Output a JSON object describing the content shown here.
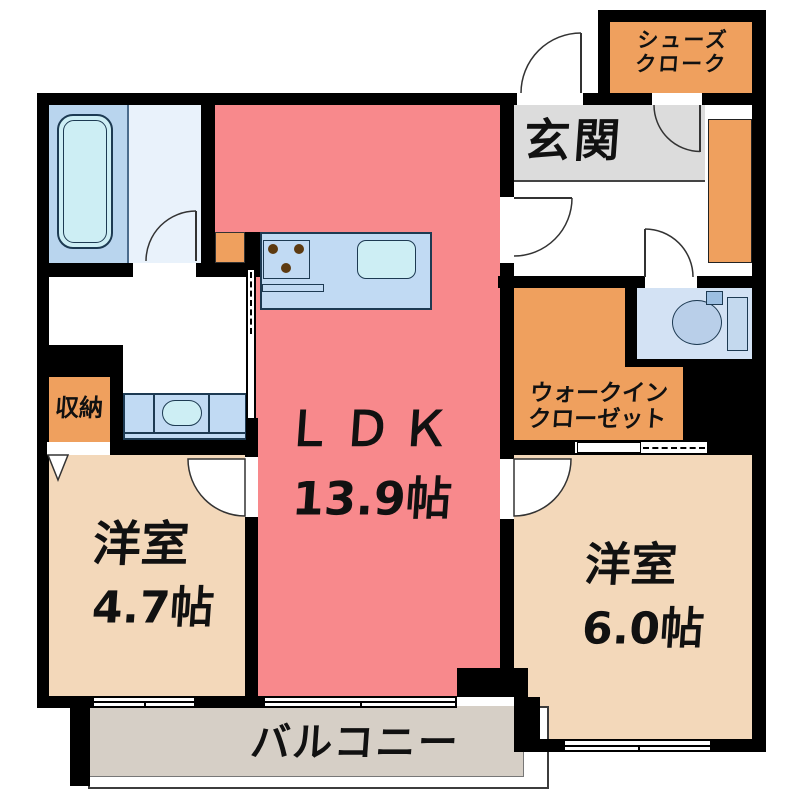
{
  "floorplan": {
    "rooms": {
      "ldk": {
        "name": "ＬＤＫ",
        "size": "13.9帖",
        "color": "#f8898c"
      },
      "bedroom_west": {
        "name": "洋室",
        "size": "4.7帖",
        "color": "#f3d8ba"
      },
      "bedroom_east": {
        "name": "洋室",
        "size": "6.0帖",
        "color": "#f3d8ba"
      },
      "entrance": {
        "name": "玄関",
        "color": "#dcdcdc"
      },
      "shoe_closet": {
        "name_line1": "シューズ",
        "name_line2": "クローク",
        "color": "#efa05e"
      },
      "walk_in_closet": {
        "name_line1": "ウォークイン",
        "name_line2": "クローゼット",
        "color": "#efa05e"
      },
      "storage": {
        "name": "収納",
        "color": "#efa05e"
      },
      "balcony": {
        "name": "バルコニー",
        "color": "#d6cfc6"
      }
    },
    "palette": {
      "wall": "#000000",
      "bathroom_blue": "#b9d5ee",
      "bathroom_light": "#e9f2fb",
      "counter_blue": "#c1daf3",
      "fixture_cyan": "#cdeef4",
      "toilet_room_blue": "#d3e2f4"
    }
  }
}
